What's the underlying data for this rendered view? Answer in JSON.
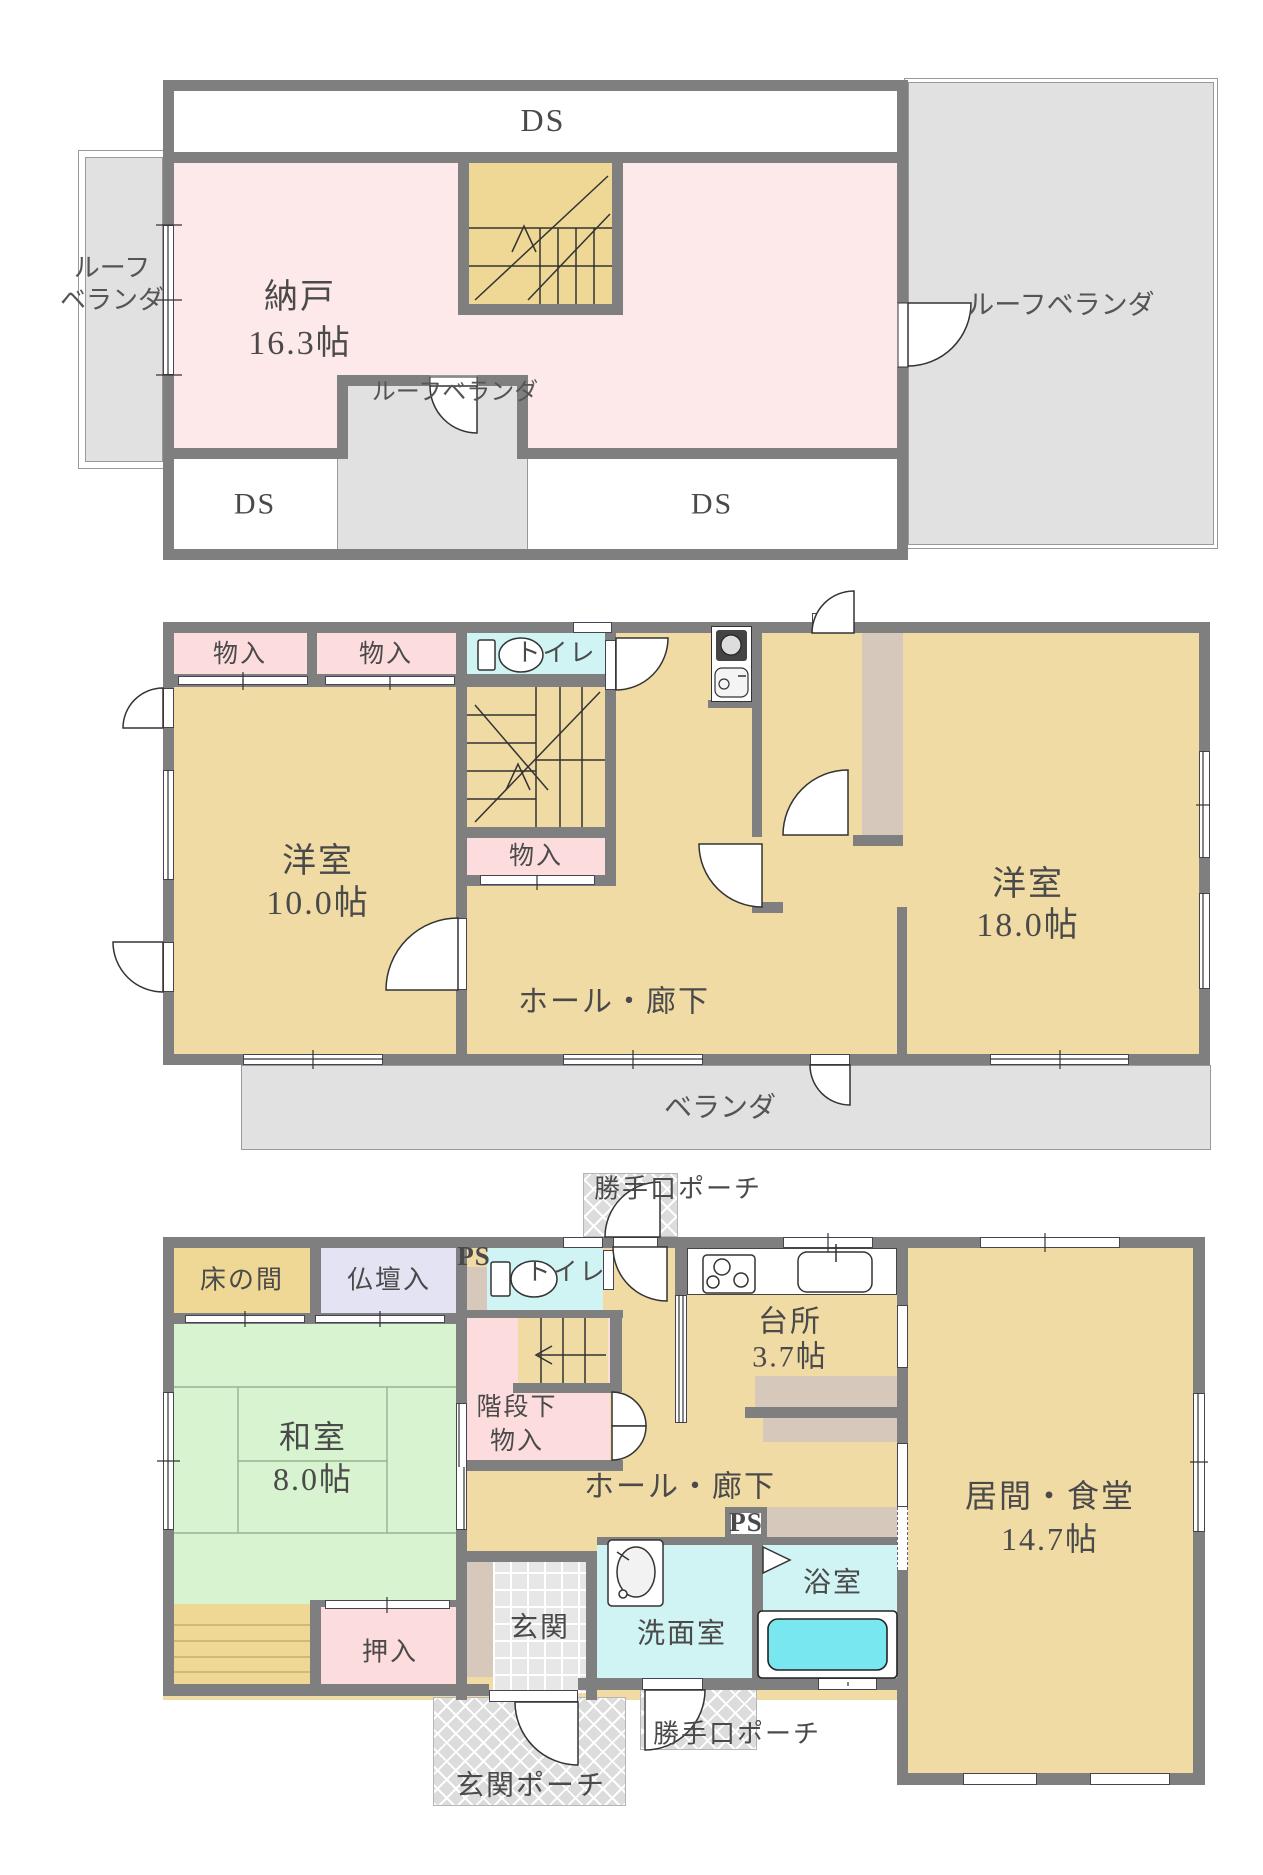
{
  "colors": {
    "wall": "#7f7f7f",
    "floor_tan": "#f0dba4",
    "room_pink": "#fde9e9",
    "closet_pink": "#fcdcdc",
    "stair_yellow": "#efd895",
    "water_cyan": "#d0f3f3",
    "bathtub_cyan": "#79e7f0",
    "altar_lavender": "#e3e3f3",
    "tatami_green": "#d8f3cf",
    "counter_beige": "#d6c9bb",
    "balcony_gray": "#e1e1e1",
    "label_text": "#4a4a4a"
  },
  "floor3": {
    "ds_top": "DS",
    "nando": "納戸",
    "nando_size": "16.3帖",
    "roof_left_line1": "ルーフ",
    "roof_left_line2": "ベランダ",
    "roof_right": "ルーフベランダ",
    "roof_mid": "ルーフベランダ",
    "ds_left": "DS",
    "ds_right": "DS"
  },
  "floor2": {
    "closet1": "物入",
    "closet2": "物入",
    "toilet": "トイレ",
    "closet3": "物入",
    "room10": "洋室",
    "room10_size": "10.0帖",
    "hall": "ホール・廊下",
    "room18": "洋室",
    "room18_size": "18.0帖",
    "veranda": "ベランダ"
  },
  "floor1": {
    "porch_back_top": "勝手口ポーチ",
    "ps1": "PS",
    "toilet": "トイレ",
    "tokonoma": "床の間",
    "butsudan": "仏壇入",
    "washitsu": "和室",
    "washitsu_size": "8.0帖",
    "stair_closet_line1": "階段下",
    "stair_closet_line2": "物入",
    "kitchen": "台所",
    "kitchen_size": "3.7帖",
    "hall": "ホール・廊下",
    "ps2": "PS",
    "living": "居間・食堂",
    "living_size": "14.7帖",
    "oshiire": "押入",
    "genkan": "玄関",
    "senmen": "洗面室",
    "bath": "浴室",
    "porch_front": "玄関ポーチ",
    "porch_back_bottom": "勝手口ポーチ"
  }
}
